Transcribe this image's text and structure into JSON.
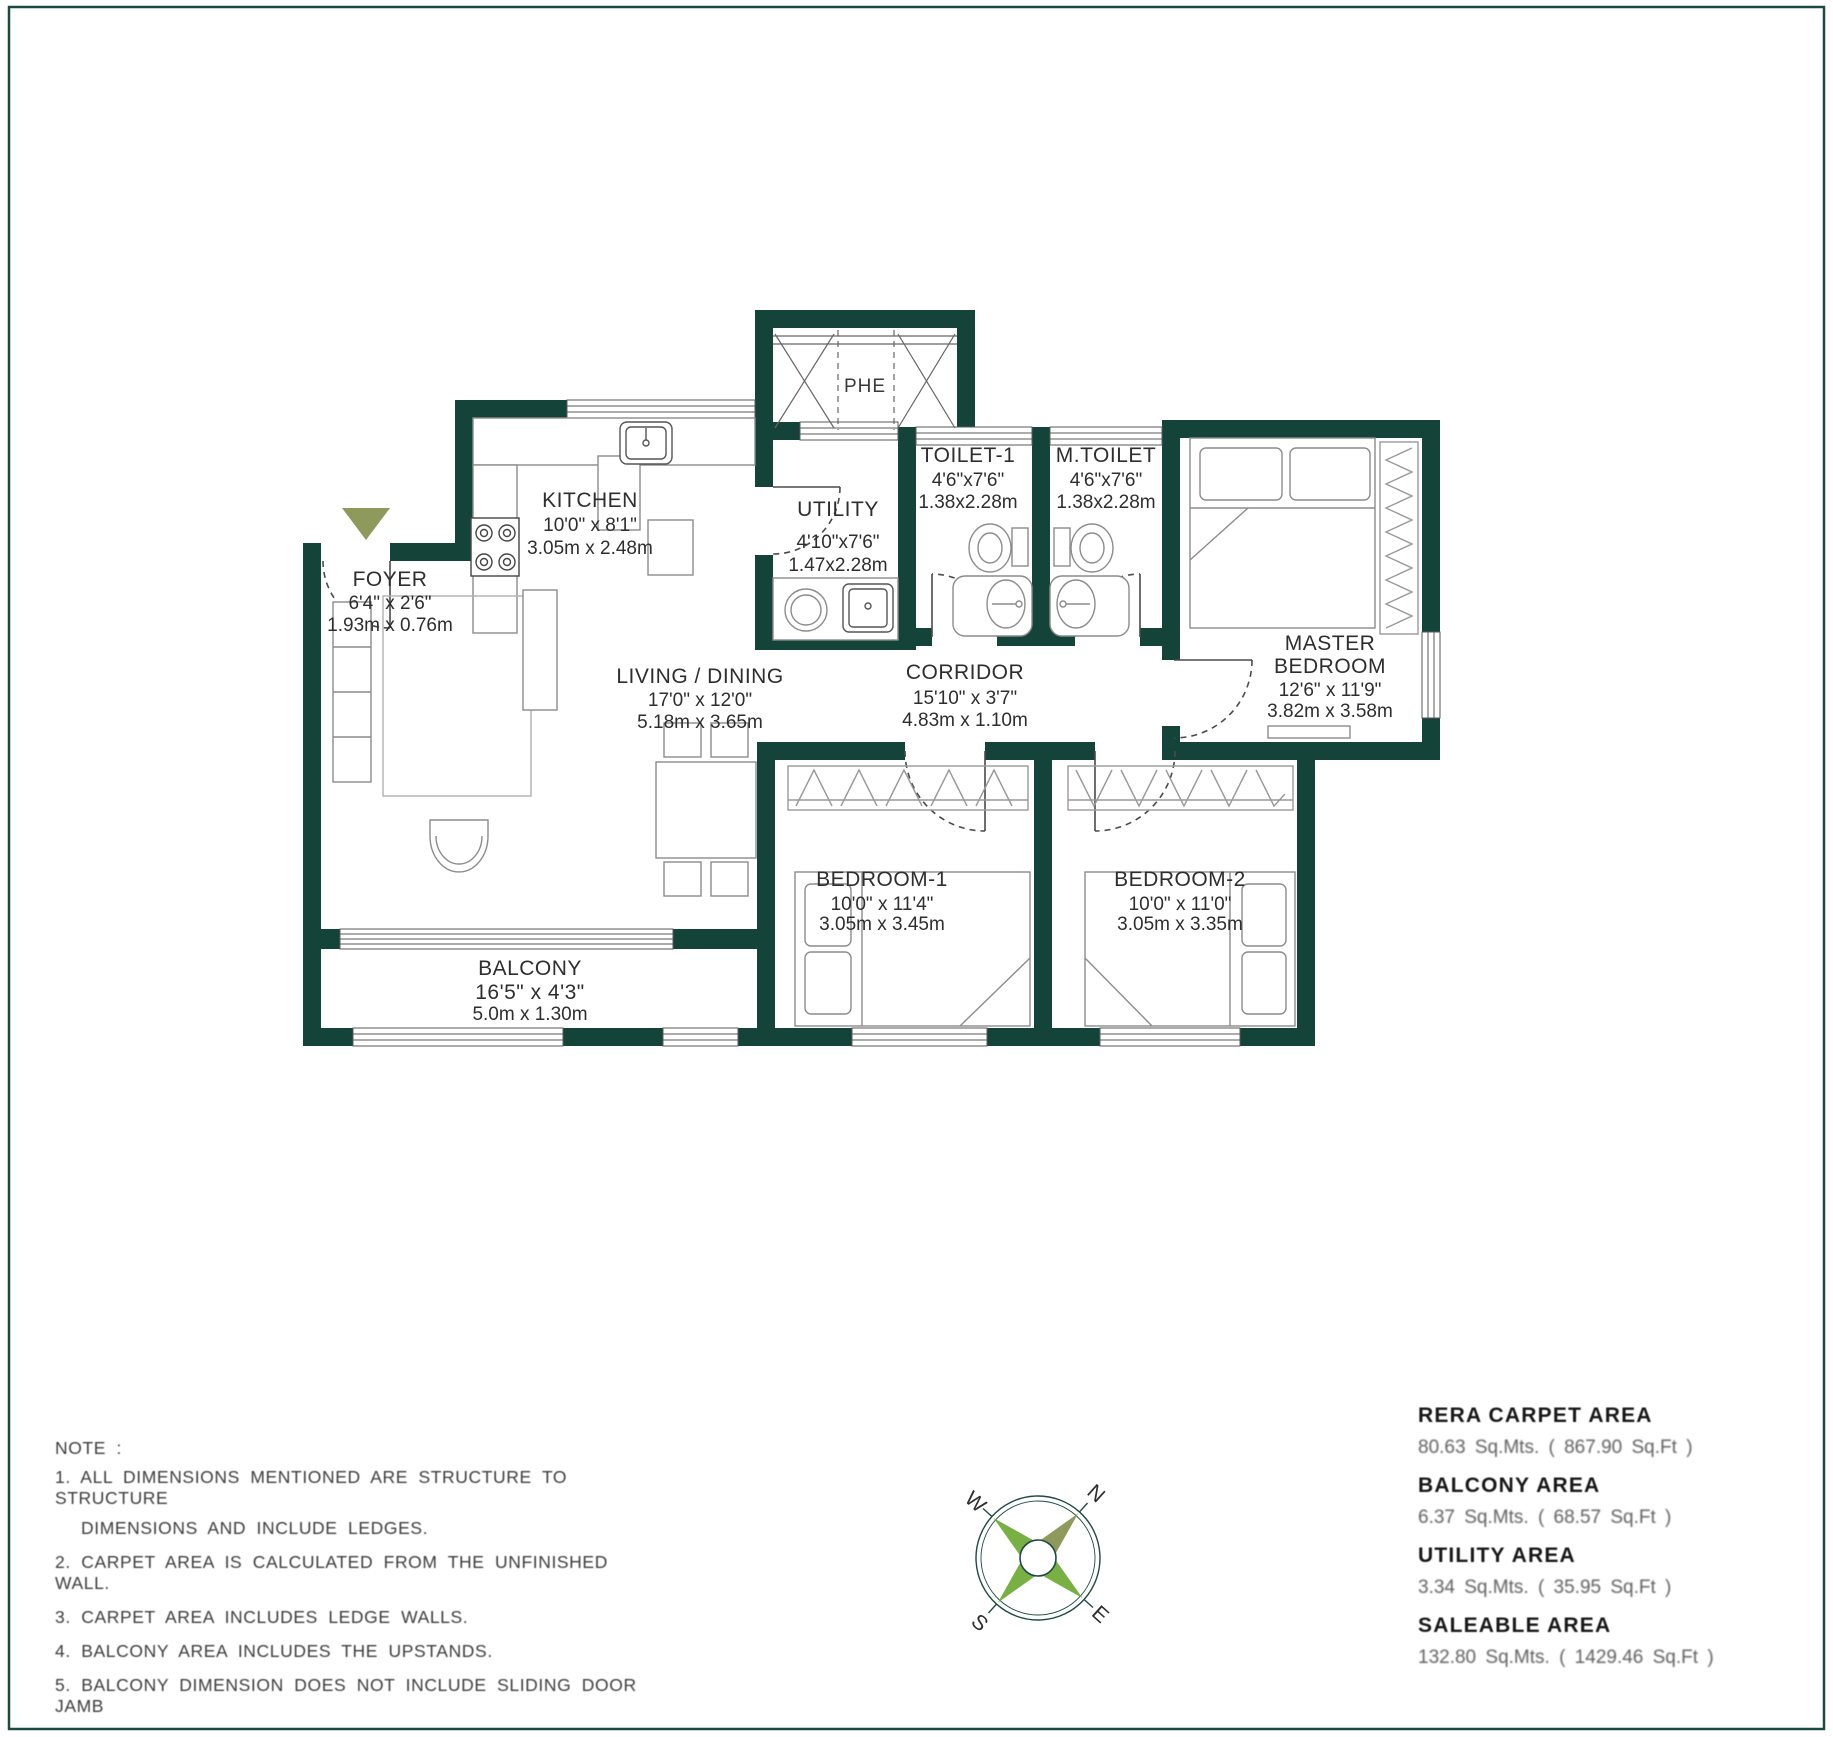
{
  "colors": {
    "wall": "#14433A",
    "ring": "#1d4a42",
    "accent_green": "#79b043",
    "olive": "#8E995C"
  },
  "plan": {
    "rooms": {
      "phe": {
        "name": "PHE"
      },
      "foyer": {
        "name": "FOYER",
        "dim_ft": "6'4\" x 2'6\"",
        "dim_m": "1.93m x 0.76m"
      },
      "kitchen": {
        "name": "KITCHEN",
        "dim_ft": "10'0\" x 8'1\"",
        "dim_m": "3.05m x 2.48m"
      },
      "utility": {
        "name": "UTILITY",
        "dim_ft": "4'10\"x7'6\"",
        "dim_m": "1.47x2.28m"
      },
      "toilet1": {
        "name": "TOILET-1",
        "dim_ft": "4'6\"x7'6\"",
        "dim_m": "1.38x2.28m"
      },
      "mtoilet": {
        "name": "M.TOILET",
        "dim_ft": "4'6\"x7'6\"",
        "dim_m": "1.38x2.28m"
      },
      "master": {
        "name_line1": "MASTER",
        "name_line2": "BEDROOM",
        "dim_ft": "12'6\" x 11'9\"",
        "dim_m": "3.82m x 3.58m"
      },
      "living": {
        "name": "LIVING / DINING",
        "dim_ft": "17'0\" x 12'0\"",
        "dim_m": "5.18m x 3.65m"
      },
      "corridor": {
        "name": "CORRIDOR",
        "dim_ft": "15'10\" x 3'7\"",
        "dim_m": "4.83m x 1.10m"
      },
      "bedroom1": {
        "name": "BEDROOM-1",
        "dim_ft": "10'0\" x 11'4\"",
        "dim_m": "3.05m x 3.45m"
      },
      "bedroom2": {
        "name": "BEDROOM-2",
        "dim_ft": "10'0\" x 11'0\"",
        "dim_m": "3.05m x 3.35m"
      },
      "balcony": {
        "name": "BALCONY",
        "dim_ft": "16'5\" x 4'3\"",
        "dim_m": "5.0m x 1.30m"
      }
    }
  },
  "notes": {
    "lines": [
      "NOTE :",
      "1.  ALL DIMENSIONS MENTIONED ARE STRUCTURE TO STRUCTURE",
      "DIMENSIONS AND INCLUDE LEDGES.",
      "2.  CARPET AREA IS CALCULATED FROM THE UNFINISHED WALL.",
      "3.  CARPET AREA INCLUDES LEDGE WALLS.",
      "4.  BALCONY AREA INCLUDES THE UPSTANDS.",
      "5.  BALCONY DIMENSION DOES NOT INCLUDE SLIDING DOOR JAMB"
    ]
  },
  "areas": [
    {
      "label": "RERA CARPET AREA",
      "value": "80.63 Sq.Mts. ( 867.90 Sq.Ft )"
    },
    {
      "label": "BALCONY AREA",
      "value": "6.37 Sq.Mts. ( 68.57 Sq.Ft )"
    },
    {
      "label": "UTILITY AREA",
      "value": "3.34 Sq.Mts. ( 35.95 Sq.Ft )"
    },
    {
      "label": "SALEABLE AREA",
      "value": "132.80 Sq.Mts. ( 1429.46 Sq.Ft )"
    }
  ],
  "compass": {
    "n": "N",
    "e": "E",
    "s": "S",
    "w": "W"
  }
}
